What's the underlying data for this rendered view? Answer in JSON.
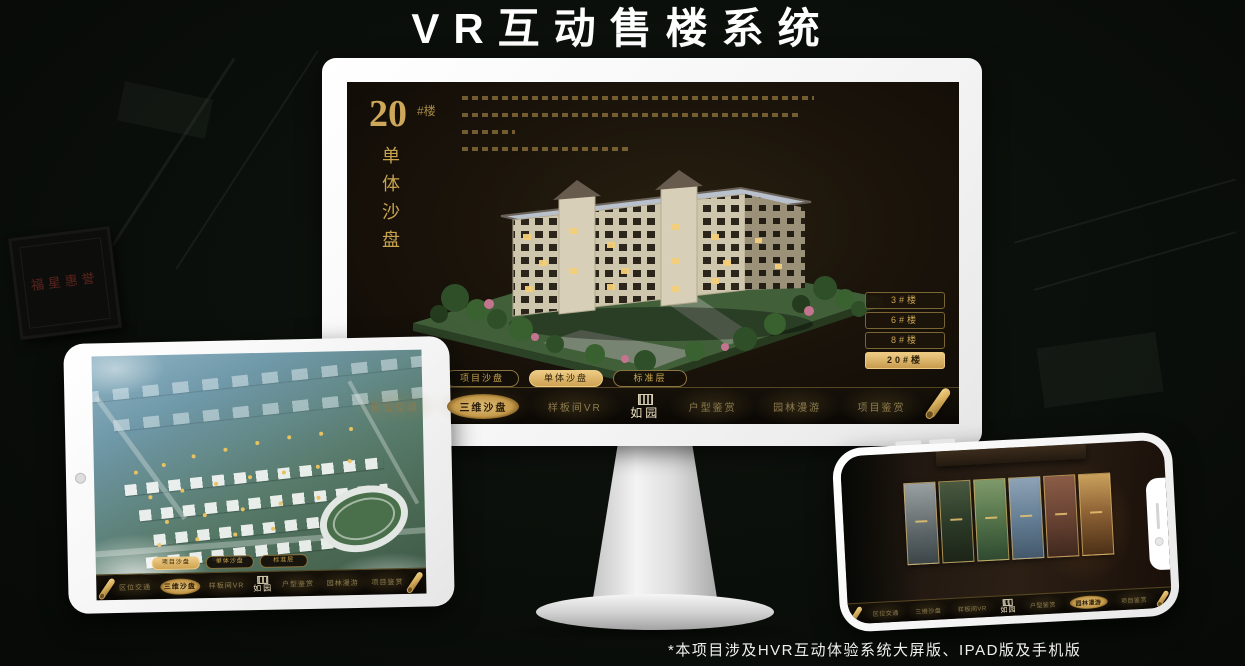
{
  "title": "VR互动售楼系统",
  "footnote": "*本项目涉及HVR互动体验系统大屏版、IPAD版及手机版",
  "colors": {
    "gold": "#c99c4b",
    "gold_bright": "#f0cd85",
    "screen_bg": "#1b140b",
    "nav_text": "#8d7b4e",
    "bezel_white": "#ffffff"
  },
  "background": {
    "plaque_text": "福星惠誉"
  },
  "nav": {
    "logo": "如园",
    "items": [
      "区位交通",
      "三维沙盘",
      "样板间VR",
      "户型鉴赏",
      "园林漫游",
      "项目鉴赏"
    ]
  },
  "monitor_app": {
    "heading_number": "20",
    "heading_unit": "#楼",
    "heading_subtitle": "单体沙盘",
    "floor_buttons": [
      {
        "label": "3#楼",
        "active": false
      },
      {
        "label": "6#楼",
        "active": false
      },
      {
        "label": "8#楼",
        "active": false
      },
      {
        "label": "20#楼",
        "active": true
      }
    ],
    "sub_tabs": [
      {
        "label": "项目沙盘",
        "active": false
      },
      {
        "label": "单体沙盘",
        "active": true
      },
      {
        "label": "标准层",
        "active": false
      }
    ],
    "active_nav_item": "三维沙盘"
  },
  "tablet_app": {
    "sub_tabs": [
      {
        "label": "项目沙盘",
        "active": true
      },
      {
        "label": "单体沙盘",
        "active": false
      },
      {
        "label": "标准层",
        "active": false
      }
    ],
    "active_nav_item": "三维沙盘"
  },
  "phone_app": {
    "active_nav_item": "园林漫游"
  }
}
